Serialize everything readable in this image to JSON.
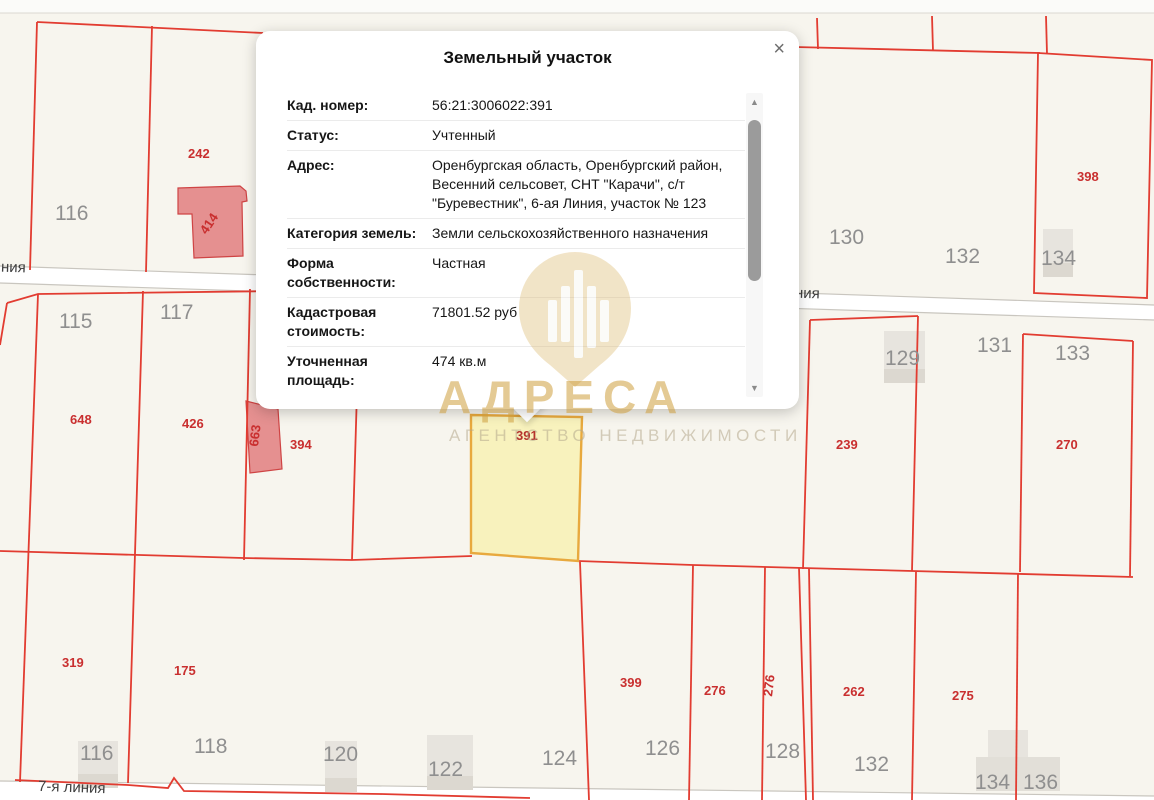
{
  "popup": {
    "title": "Земельный участок",
    "close_icon": "×",
    "rows": [
      {
        "label": "Кад. номер:",
        "value": "56:21:3006022:391"
      },
      {
        "label": "Статус:",
        "value": "Учтенный"
      },
      {
        "label": "Адрес:",
        "value": "Оренбургская область, Оренбургский район, Весенний сельсовет, СНТ \"Карачи\", с/т \"Буревестник\", 6-ая Линия, участок № 123"
      },
      {
        "label": "Категория земель:",
        "value": "Земли сельскохозяйственного назначения"
      },
      {
        "label": "Форма собственности:",
        "value": "Частная"
      },
      {
        "label": "Кадастровая стоимость:",
        "value": "71801.52 руб"
      },
      {
        "label": "Уточненная площадь:",
        "value": "474 кв.м"
      }
    ],
    "scrollbar": {
      "up_arrow": "▲",
      "down_arrow": "▼"
    }
  },
  "map": {
    "highlight_label": "391",
    "street_labels": [
      "ния",
      "ния",
      "7-я линия"
    ],
    "red_labels": [
      "242",
      "414",
      "648",
      "426",
      "663",
      "394",
      "239",
      "270",
      "398",
      "319",
      "175",
      "399",
      "276",
      "276",
      "262",
      "275"
    ],
    "gray_labels": [
      "116",
      "115",
      "117",
      "130",
      "132",
      "134",
      "129",
      "131",
      "133",
      "116",
      "118",
      "120",
      "122",
      "124",
      "126",
      "128",
      "132",
      "134",
      "136"
    ],
    "colors": {
      "parcel_line": "#e23c31",
      "highlight_fill": "#f8f2bd",
      "highlight_border": "#e8a93e",
      "building_pink": "#e59090",
      "building_gray": "#e7e4de",
      "background": "#f7f5ee"
    }
  },
  "watermark": {
    "title": "АДРЕСА",
    "subtitle": "АГЕНТСТВО НЕДВИЖИМОСТИ"
  }
}
